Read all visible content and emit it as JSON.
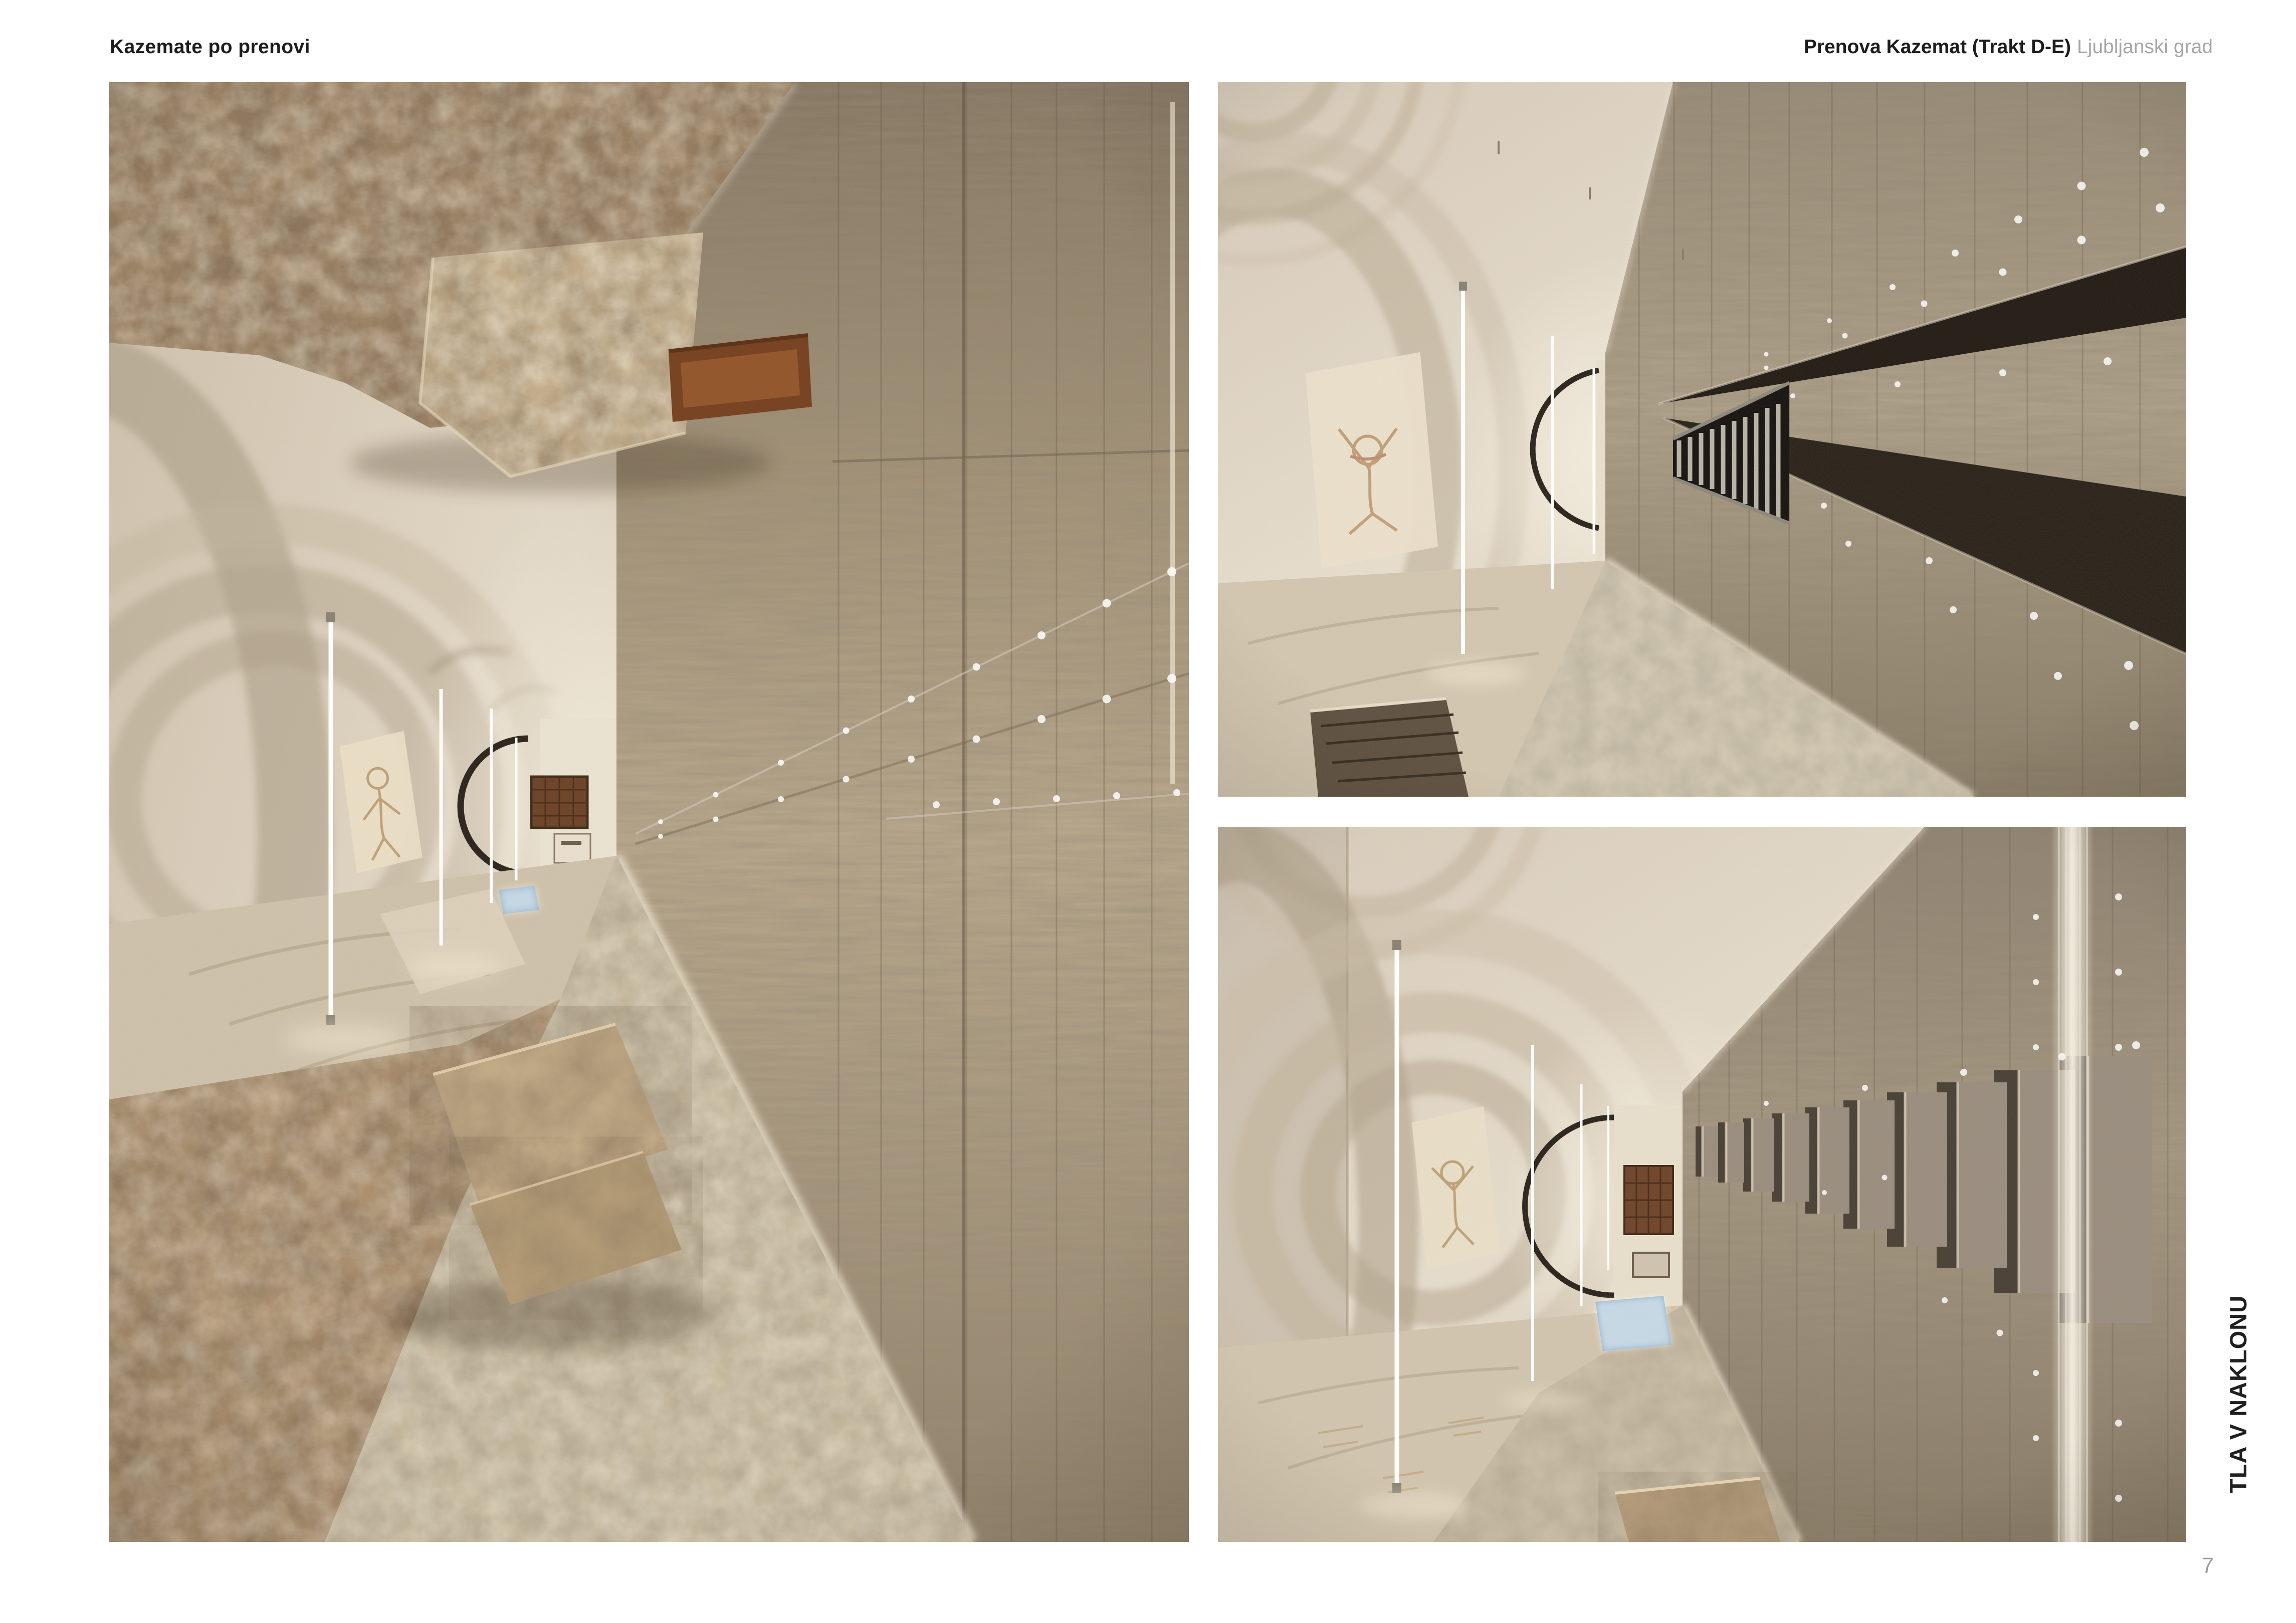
{
  "header": {
    "left_title": "Kazemate po prenovi",
    "right_title_bold": "Prenova Kazemat (Trakt D-E)",
    "right_title_light": "Ljubljanski grad"
  },
  "side_label": "TLA V NAKLONU",
  "page_number": "7",
  "photos": {
    "left_alt": "Renovated casemate corridor (rotated view): rubble stone vault, oak plank wall with rows of light reflections, cream plaster arches with vertical LED strips, lattice window at corridor end, cobblestone floor and large tufa stone blocks",
    "top_right_alt": "Renovated casemate corridor (rotated view): plaster vault with faint fresco, vertical LED strips, oak wall with dark recessed channel and metal stair, rivet reflections, cobblestone strip and floor pit",
    "bottom_right_alt": "Renovated casemate corridor (rotated view): plaster vault arches with LED strips, fresco trace, lattice window, blue skylight on floor, oak wall with protruding panels and glowing vertical seam, cobblestone path"
  },
  "colors": {
    "page_background": "#ffffff",
    "ink": "#1d1d1b",
    "muted_text": "#a5a5a5",
    "page_number_gray": "#9b9b9b",
    "plaster": "#ddd2c0",
    "wood": "#a3947b",
    "stone": "#9c8263",
    "led_light": "#ffffff",
    "skylight_blue": "#8fb3cf"
  }
}
